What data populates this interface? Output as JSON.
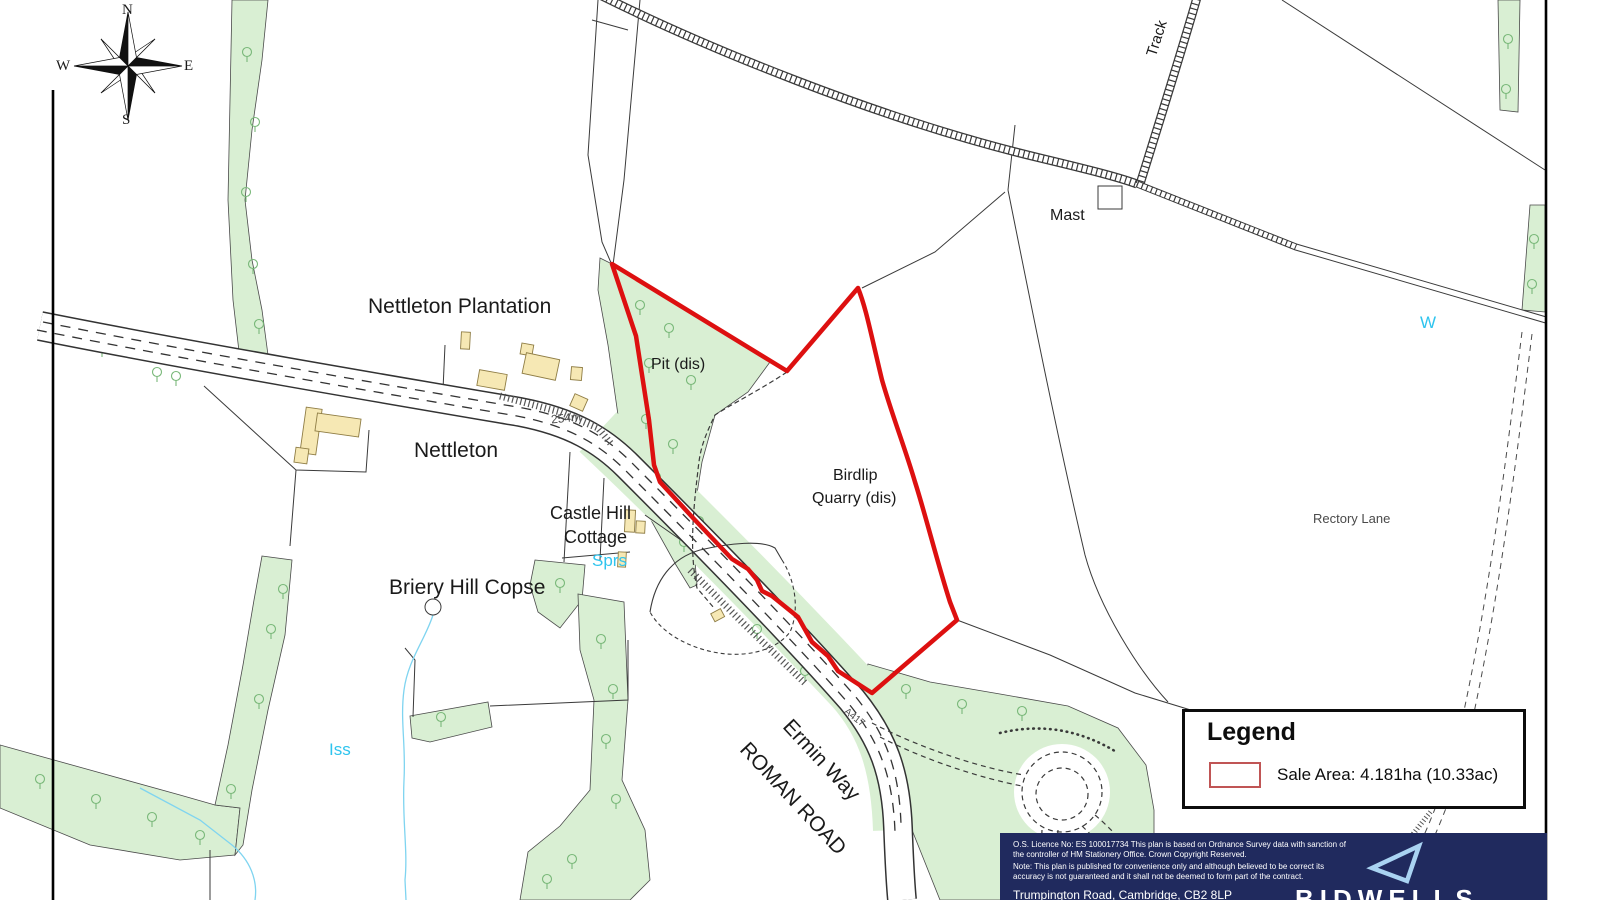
{
  "map": {
    "labels": {
      "nettleton_plantation": "Nettleton Plantation",
      "nettleton": "Nettleton",
      "castle_hill_line1": "Castle Hill",
      "castle_hill_line2": "Cottage",
      "briery_hill_copse": "Briery Hill Copse",
      "pit_dis": "Pit (dis)",
      "birdlip_line1": "Birdlip",
      "birdlip_line2": "Quarry (dis)",
      "mast": "Mast",
      "track": "Track",
      "rectory_lane": "Rectory Lane",
      "w_water": "W",
      "sprs": "Sprs",
      "iss": "Iss",
      "spot_height": "254m",
      "a417": "A417",
      "ermin_way": "Ermin Way",
      "roman_road": "ROMAN ROAD"
    },
    "compass": {
      "n": "N",
      "e": "E",
      "s": "S",
      "w": "W"
    }
  },
  "legend": {
    "title": "Legend",
    "sale_area": "Sale Area: 4.181ha (10.33ac)"
  },
  "footer": {
    "os_line": "O.S. Licence No: ES 100017734 This plan is based on Ordnance Survey data with sanction of the controller of HM Stationery Office. Crown Copyright Reserved.",
    "note_line": "Note: This plan is published for convenience only and although believed to be correct its accuracy is not guaranteed and it shall not be deemed to form part of the contract.",
    "address": "Trumpington Road, Cambridge, CB2 8LP",
    "brand": "BIDWELLS"
  },
  "colors": {
    "sale_area_red": "#dd1010",
    "woodland_green": "#d9efd3",
    "water_cyan": "#2fc4ee",
    "brand_navy": "#202a5e",
    "brand_light_blue": "#a9d3f2",
    "building_tan": "#f6e8b4"
  }
}
